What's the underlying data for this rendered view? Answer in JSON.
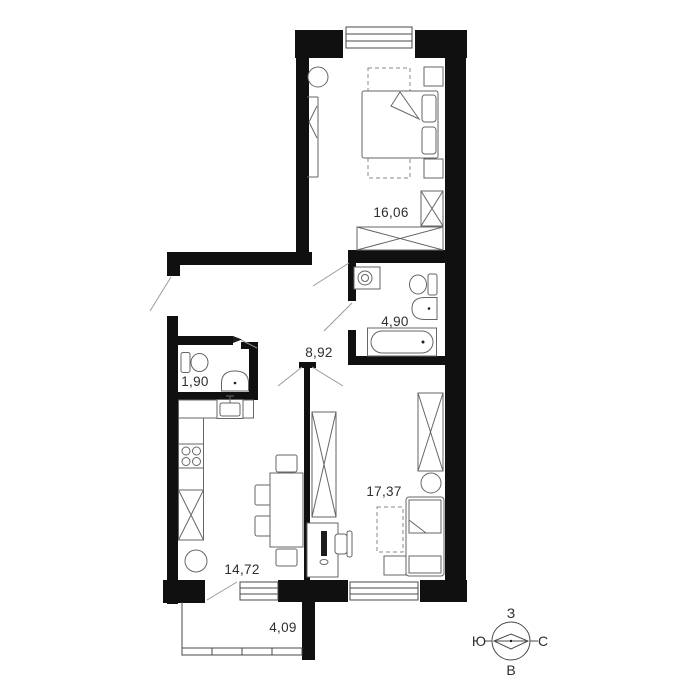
{
  "rooms": {
    "bedroom": {
      "area": "16,06"
    },
    "bathroom": {
      "area": "4,90"
    },
    "hallway": {
      "area": "8,92"
    },
    "wc": {
      "area": "1,90"
    },
    "living_room": {
      "area": "17,37"
    },
    "kitchen": {
      "area": "14,72"
    },
    "balcony": {
      "area": "4,09"
    }
  },
  "compass": {
    "top": "З",
    "left": "Ю",
    "right": "С",
    "bottom": "В"
  },
  "colors": {
    "wall": "#101010",
    "furniture_stroke": "#666666",
    "text": "#2e2e2e"
  }
}
